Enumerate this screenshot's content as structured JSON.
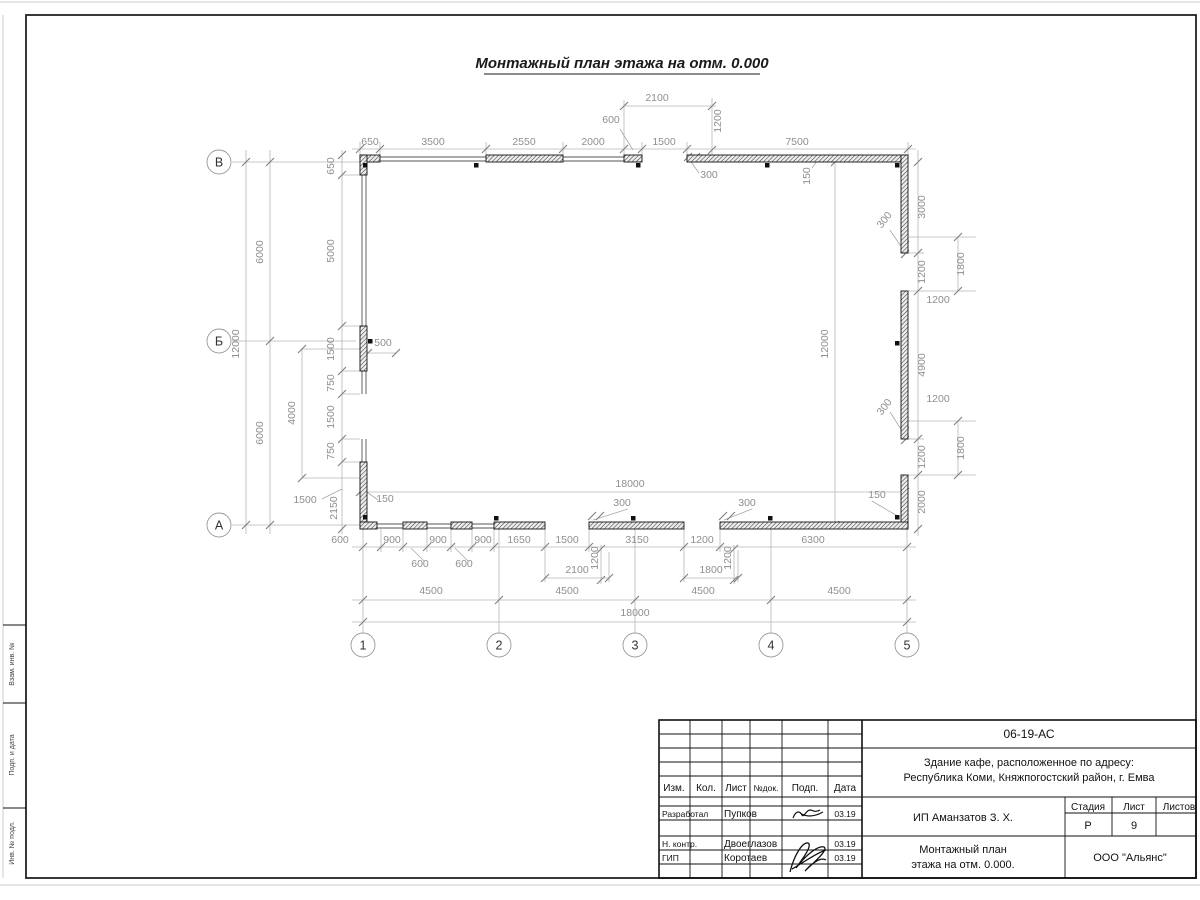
{
  "sheet": {
    "title": "Монтажный план этажа на отм. 0.000"
  },
  "frame": {
    "side_labels": [
      "Взам. инв. №",
      "Подп. и дата",
      "Инв. № подл."
    ]
  },
  "plan": {
    "axes": [
      {
        "label": "В",
        "cx": 219,
        "cy": 162
      },
      {
        "label": "Б",
        "cx": 219,
        "cy": 341
      },
      {
        "label": "А",
        "cx": 219,
        "cy": 525
      },
      {
        "label": "1",
        "cx": 363,
        "cy": 645
      },
      {
        "label": "2",
        "cx": 499,
        "cy": 645
      },
      {
        "label": "3",
        "cx": 635,
        "cy": 645
      },
      {
        "label": "4",
        "cx": 771,
        "cy": 645
      },
      {
        "label": "5",
        "cx": 907,
        "cy": 645
      }
    ],
    "walls": [
      [
        360,
        155,
        20,
        7
      ],
      [
        486,
        155,
        77,
        7
      ],
      [
        624,
        155,
        18,
        7
      ],
      [
        687,
        155,
        221,
        7
      ],
      [
        360,
        155,
        7,
        20
      ],
      [
        360,
        326,
        7,
        45
      ],
      [
        360,
        462,
        7,
        67
      ],
      [
        901,
        155,
        7,
        98
      ],
      [
        901,
        291,
        7,
        148
      ],
      [
        901,
        475,
        7,
        54
      ],
      [
        360,
        522,
        17,
        7
      ],
      [
        403,
        522,
        24,
        7
      ],
      [
        451,
        522,
        21,
        7
      ],
      [
        494,
        522,
        51,
        7
      ],
      [
        589,
        522,
        95,
        7
      ],
      [
        720,
        522,
        188,
        7
      ]
    ],
    "thin_lines": [
      [
        380,
        157,
        486,
        157
      ],
      [
        380,
        161,
        486,
        161
      ],
      [
        563,
        157,
        624,
        157
      ],
      [
        563,
        161,
        624,
        161
      ],
      [
        362,
        175,
        362,
        326
      ],
      [
        366,
        175,
        366,
        326
      ],
      [
        362,
        371,
        362,
        394
      ],
      [
        366,
        371,
        366,
        394
      ],
      [
        362,
        439,
        362,
        462
      ],
      [
        366,
        439,
        366,
        462
      ],
      [
        377,
        524,
        403,
        524
      ],
      [
        377,
        528,
        403,
        528
      ],
      [
        427,
        524,
        451,
        524
      ],
      [
        427,
        528,
        451,
        528
      ],
      [
        472,
        524,
        494,
        524
      ],
      [
        472,
        528,
        494,
        528
      ]
    ],
    "dim_lines": [
      [
        352,
        149,
        916,
        149
      ],
      [
        624,
        106,
        716,
        106
      ],
      [
        360,
        492,
        905,
        492
      ],
      [
        352,
        547,
        916,
        547
      ],
      [
        545,
        578,
        609,
        578
      ],
      [
        684,
        578,
        738,
        578
      ],
      [
        352,
        600,
        916,
        600
      ],
      [
        352,
        622,
        916,
        622
      ],
      [
        908,
        237,
        976,
        237
      ],
      [
        908,
        291,
        976,
        291
      ],
      [
        908,
        421,
        976,
        421
      ],
      [
        908,
        475,
        976,
        475
      ],
      [
        302,
        349,
        360,
        349
      ],
      [
        302,
        478,
        360,
        478
      ],
      [
        232,
        162,
        360,
        162
      ],
      [
        232,
        341,
        356,
        341
      ],
      [
        232,
        525,
        360,
        525
      ],
      [
        368,
        353,
        396,
        353
      ],
      [
        908,
        253,
        924,
        253
      ],
      [
        908,
        439,
        924,
        439
      ],
      [
        342,
        175,
        360,
        175
      ],
      [
        342,
        326,
        360,
        326
      ],
      [
        342,
        371,
        360,
        371
      ],
      [
        342,
        394,
        360,
        394
      ],
      [
        342,
        439,
        360,
        439
      ],
      [
        342,
        462,
        360,
        462
      ],
      [
        342,
        150,
        342,
        534
      ],
      [
        302,
        349,
        302,
        478
      ],
      [
        270,
        150,
        270,
        534
      ],
      [
        246,
        150,
        246,
        534
      ],
      [
        835,
        162,
        835,
        525
      ],
      [
        918,
        150,
        918,
        536
      ],
      [
        958,
        237,
        958,
        291
      ],
      [
        958,
        421,
        958,
        475
      ],
      [
        712,
        98,
        712,
        158
      ],
      [
        601,
        545,
        601,
        584
      ],
      [
        734,
        545,
        734,
        584
      ],
      [
        363,
        527,
        363,
        633
      ],
      [
        499,
        527,
        499,
        633
      ],
      [
        635,
        527,
        635,
        633
      ],
      [
        771,
        527,
        771,
        633
      ],
      [
        907,
        527,
        907,
        633
      ],
      [
        380,
        142,
        380,
        156
      ],
      [
        486,
        142,
        486,
        156
      ],
      [
        563,
        142,
        563,
        156
      ],
      [
        624,
        100,
        624,
        156
      ],
      [
        642,
        142,
        642,
        156
      ],
      [
        687,
        142,
        687,
        156
      ],
      [
        908,
        142,
        908,
        155
      ],
      [
        360,
        142,
        360,
        155
      ],
      [
        381,
        529,
        381,
        552
      ],
      [
        403,
        529,
        403,
        552
      ],
      [
        427,
        529,
        427,
        552
      ],
      [
        451,
        529,
        451,
        552
      ],
      [
        472,
        529,
        472,
        552
      ],
      [
        494,
        529,
        494,
        552
      ],
      [
        545,
        529,
        545,
        582
      ],
      [
        589,
        529,
        589,
        552
      ],
      [
        684,
        529,
        684,
        582
      ],
      [
        720,
        529,
        720,
        552
      ],
      [
        609,
        552,
        609,
        582
      ],
      [
        738,
        550,
        738,
        582
      ]
    ],
    "leader_lines": [
      [
        620,
        129,
        633,
        150
      ],
      [
        424,
        561,
        411,
        548
      ],
      [
        468,
        561,
        455,
        548
      ],
      [
        699,
        173,
        689,
        159
      ],
      [
        890,
        230,
        904,
        251
      ],
      [
        890,
        412,
        904,
        434
      ],
      [
        628,
        509,
        593,
        520
      ],
      [
        752,
        509,
        724,
        520
      ],
      [
        378,
        500,
        364,
        490
      ],
      [
        872,
        501,
        899,
        517
      ],
      [
        812,
        168,
        820,
        157
      ],
      [
        322,
        499,
        342,
        489
      ]
    ],
    "ticks": [
      [
        360,
        149
      ],
      [
        380,
        149
      ],
      [
        486,
        149
      ],
      [
        563,
        149
      ],
      [
        624,
        149
      ],
      [
        642,
        149
      ],
      [
        687,
        149
      ],
      [
        908,
        149
      ],
      [
        624,
        106
      ],
      [
        712,
        106
      ],
      [
        360,
        492
      ],
      [
        905,
        492
      ],
      [
        363,
        547
      ],
      [
        381,
        547
      ],
      [
        403,
        547
      ],
      [
        427,
        547
      ],
      [
        451,
        547
      ],
      [
        472,
        547
      ],
      [
        494,
        547
      ],
      [
        545,
        547
      ],
      [
        589,
        547
      ],
      [
        684,
        547
      ],
      [
        720,
        547
      ],
      [
        907,
        547
      ],
      [
        545,
        578
      ],
      [
        609,
        578
      ],
      [
        684,
        578
      ],
      [
        738,
        578
      ],
      [
        363,
        600
      ],
      [
        499,
        600
      ],
      [
        635,
        600
      ],
      [
        771,
        600
      ],
      [
        907,
        600
      ],
      [
        363,
        622
      ],
      [
        907,
        622
      ],
      [
        342,
        155
      ],
      [
        342,
        175
      ],
      [
        342,
        326
      ],
      [
        342,
        371
      ],
      [
        342,
        394
      ],
      [
        342,
        439
      ],
      [
        342,
        462
      ],
      [
        342,
        529
      ],
      [
        302,
        349
      ],
      [
        302,
        478
      ],
      [
        270,
        162
      ],
      [
        270,
        341
      ],
      [
        270,
        525
      ],
      [
        246,
        162
      ],
      [
        246,
        525
      ],
      [
        835,
        162
      ],
      [
        835,
        525
      ],
      [
        918,
        162
      ],
      [
        918,
        253
      ],
      [
        918,
        291
      ],
      [
        918,
        439
      ],
      [
        918,
        475
      ],
      [
        918,
        529
      ],
      [
        958,
        237
      ],
      [
        958,
        291
      ],
      [
        958,
        421
      ],
      [
        958,
        475
      ],
      [
        712,
        150
      ],
      [
        601,
        549
      ],
      [
        601,
        580
      ],
      [
        734,
        549
      ],
      [
        734,
        580
      ],
      [
        688,
        157
      ],
      [
        696,
        157
      ],
      [
        905,
        245
      ],
      [
        905,
        254
      ],
      [
        905,
        431
      ],
      [
        905,
        440
      ],
      [
        592,
        516
      ],
      [
        600,
        516
      ],
      [
        723,
        516
      ],
      [
        731,
        516
      ],
      [
        368,
        353
      ],
      [
        396,
        353
      ]
    ],
    "squares": [
      [
        363,
        163
      ],
      [
        474,
        163
      ],
      [
        636,
        163
      ],
      [
        765,
        163
      ],
      [
        895,
        163
      ],
      [
        895,
        341
      ],
      [
        368,
        339
      ],
      [
        363,
        515
      ],
      [
        494,
        516
      ],
      [
        631,
        516
      ],
      [
        768,
        516
      ],
      [
        895,
        515
      ]
    ],
    "labels": [
      [
        "650",
        370,
        145
      ],
      [
        "3500",
        433,
        145
      ],
      [
        "2550",
        524,
        145
      ],
      [
        "2000",
        593,
        145
      ],
      [
        "1500",
        664,
        145
      ],
      [
        "7500",
        797,
        145
      ],
      [
        "600",
        611,
        123
      ],
      [
        "2100",
        657,
        101
      ],
      [
        "1200",
        721,
        121,
        -90
      ],
      [
        "300",
        709,
        178
      ],
      [
        "150",
        810,
        176,
        -90
      ],
      [
        "650",
        334,
        166,
        -90
      ],
      [
        "5000",
        334,
        251,
        -90
      ],
      [
        "1500",
        334,
        349,
        -90
      ],
      [
        "750",
        334,
        383,
        -90
      ],
      [
        "1500",
        334,
        417,
        -90
      ],
      [
        "750",
        334,
        451,
        -90
      ],
      [
        "2150",
        337,
        508,
        -90
      ],
      [
        "4000",
        295,
        413,
        -90
      ],
      [
        "6000",
        263,
        252,
        -90
      ],
      [
        "6000",
        263,
        433,
        -90
      ],
      [
        "12000",
        239,
        344,
        -90
      ],
      [
        "1500",
        305,
        503
      ],
      [
        "500",
        383,
        346
      ],
      [
        "150",
        385,
        502
      ],
      [
        "18000",
        630,
        487
      ],
      [
        "12000",
        828,
        344,
        -90
      ],
      [
        "3000",
        925,
        207,
        -90
      ],
      [
        "1200",
        925,
        272,
        -90
      ],
      [
        "4900",
        925,
        365,
        -90
      ],
      [
        "1200",
        925,
        457,
        -90
      ],
      [
        "2000",
        925,
        502,
        -90
      ],
      [
        "1800",
        964,
        264,
        -90
      ],
      [
        "1800",
        964,
        448,
        -90
      ],
      [
        "1200",
        938,
        303
      ],
      [
        "1200",
        938,
        402
      ],
      [
        "300",
        887,
        222,
        -52
      ],
      [
        "300",
        887,
        409,
        -52
      ],
      [
        "150",
        877,
        498
      ],
      [
        "600",
        340,
        543
      ],
      [
        "900",
        392,
        543
      ],
      [
        "900",
        438,
        543
      ],
      [
        "900",
        483,
        543
      ],
      [
        "1650",
        519,
        543
      ],
      [
        "1500",
        567,
        543
      ],
      [
        "3150",
        637,
        543
      ],
      [
        "1200",
        702,
        543
      ],
      [
        "6300",
        813,
        543
      ],
      [
        "600",
        420,
        567
      ],
      [
        "600",
        464,
        567
      ],
      [
        "1200",
        598,
        558,
        -90
      ],
      [
        "1200",
        731,
        558,
        -90
      ],
      [
        "300",
        622,
        506
      ],
      [
        "300",
        747,
        506
      ],
      [
        "2100",
        577,
        573
      ],
      [
        "1800",
        711,
        573
      ],
      [
        "4500",
        431,
        594
      ],
      [
        "4500",
        567,
        594
      ],
      [
        "4500",
        703,
        594
      ],
      [
        "4500",
        839,
        594
      ],
      [
        "18000",
        635,
        616
      ]
    ]
  },
  "title_block": {
    "doc_number": "06-19-АС",
    "object_line1": "Здание кафе, расположенное по адресу:",
    "object_line2": "Республика Коми, Княжпогостский район, г. Емва",
    "client": "ИП Аманзатов З. Х.",
    "title_line1": "Монтажный план",
    "title_line2": "этажа на отм. 0.000.",
    "company": "ООО \"Альянс\"",
    "stage_label": "Стадия",
    "sheet_label": "Лист",
    "sheets_label": "Листов",
    "stage": "Р",
    "sheet_no": "9",
    "header_cols": [
      "Изм.",
      "Кол.",
      "Лист",
      "№док.",
      "Подп.",
      "Дата"
    ],
    "rows": [
      {
        "role": "Разработал",
        "name": "Пупков",
        "date": "03.19"
      },
      {
        "role": "Н. контр.",
        "name": "Двоеглазов",
        "date": "03.19"
      },
      {
        "role": "ГИП",
        "name": "Коротаев",
        "date": "03.19"
      }
    ]
  }
}
